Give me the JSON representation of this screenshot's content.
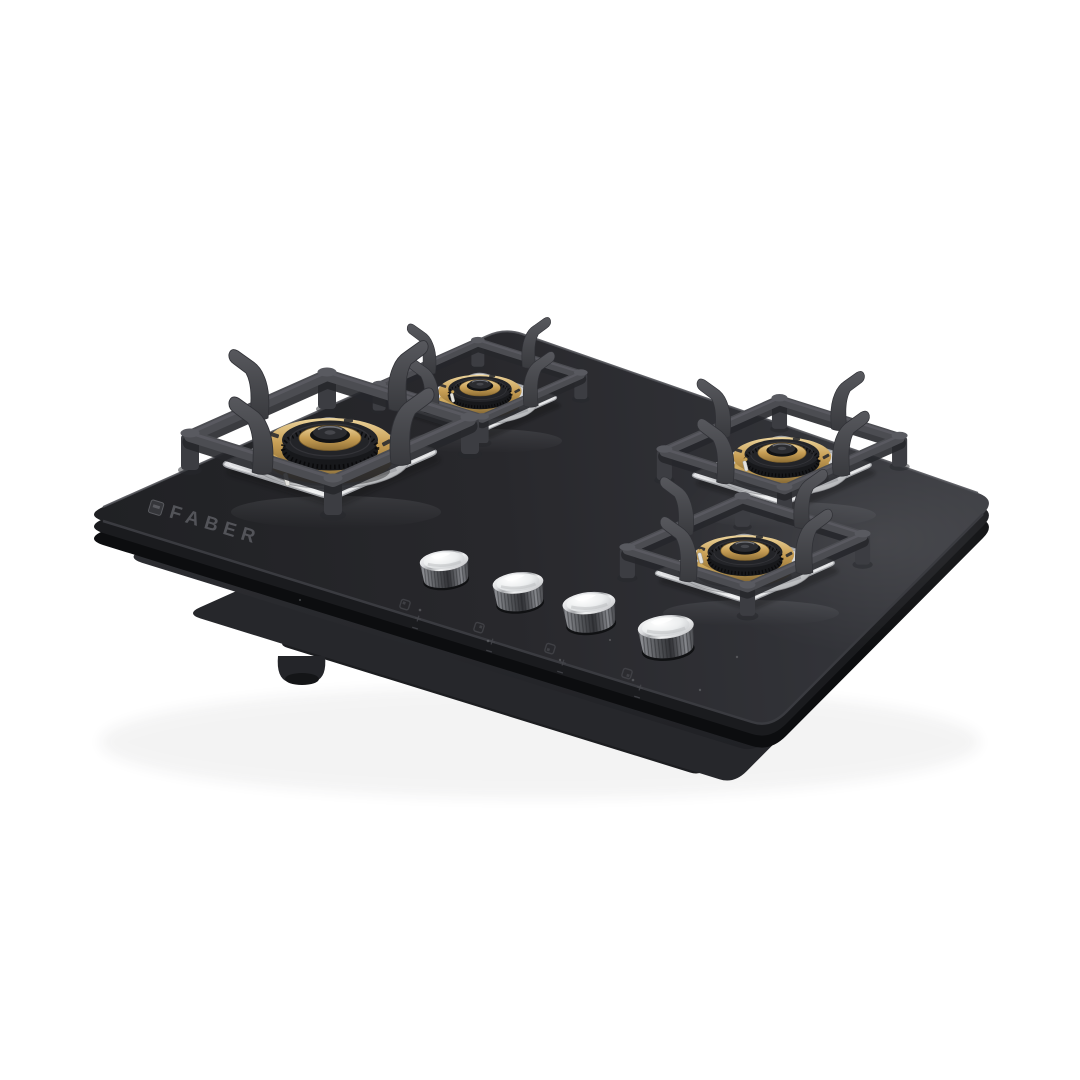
{
  "page": {
    "background_color": "#ffffff",
    "type": "product-photo",
    "subject": "4-burner built-in gas hob with black tempered glass top, brass burners and knurled metal control knobs"
  },
  "brand": {
    "logo_text": "FABER",
    "logo_icon": "faber-logo-mark-icon",
    "logo_color": "#56575c"
  },
  "hob": {
    "burner_count": 4,
    "knob_count": 4,
    "glass_color": "#28292d",
    "materials": {
      "burner_rings": "brass",
      "drip_trays": "stainless steel",
      "pan_supports": "cast iron",
      "knobs": "knurled metal"
    },
    "colors": {
      "brass": "#c89f55",
      "stainless": "#e6e7e9",
      "cast_iron": "#47484d",
      "knob_top": "#f3f4f5",
      "underbody": "#35363b"
    },
    "burners": [
      {
        "id": "front-left",
        "size": "large"
      },
      {
        "id": "rear-left",
        "size": "small"
      },
      {
        "id": "rear-right",
        "size": "medium"
      },
      {
        "id": "front-right",
        "size": "medium"
      }
    ],
    "knobs": [
      {
        "id": "knob-1"
      },
      {
        "id": "knob-2"
      },
      {
        "id": "knob-3"
      },
      {
        "id": "knob-4"
      }
    ]
  }
}
